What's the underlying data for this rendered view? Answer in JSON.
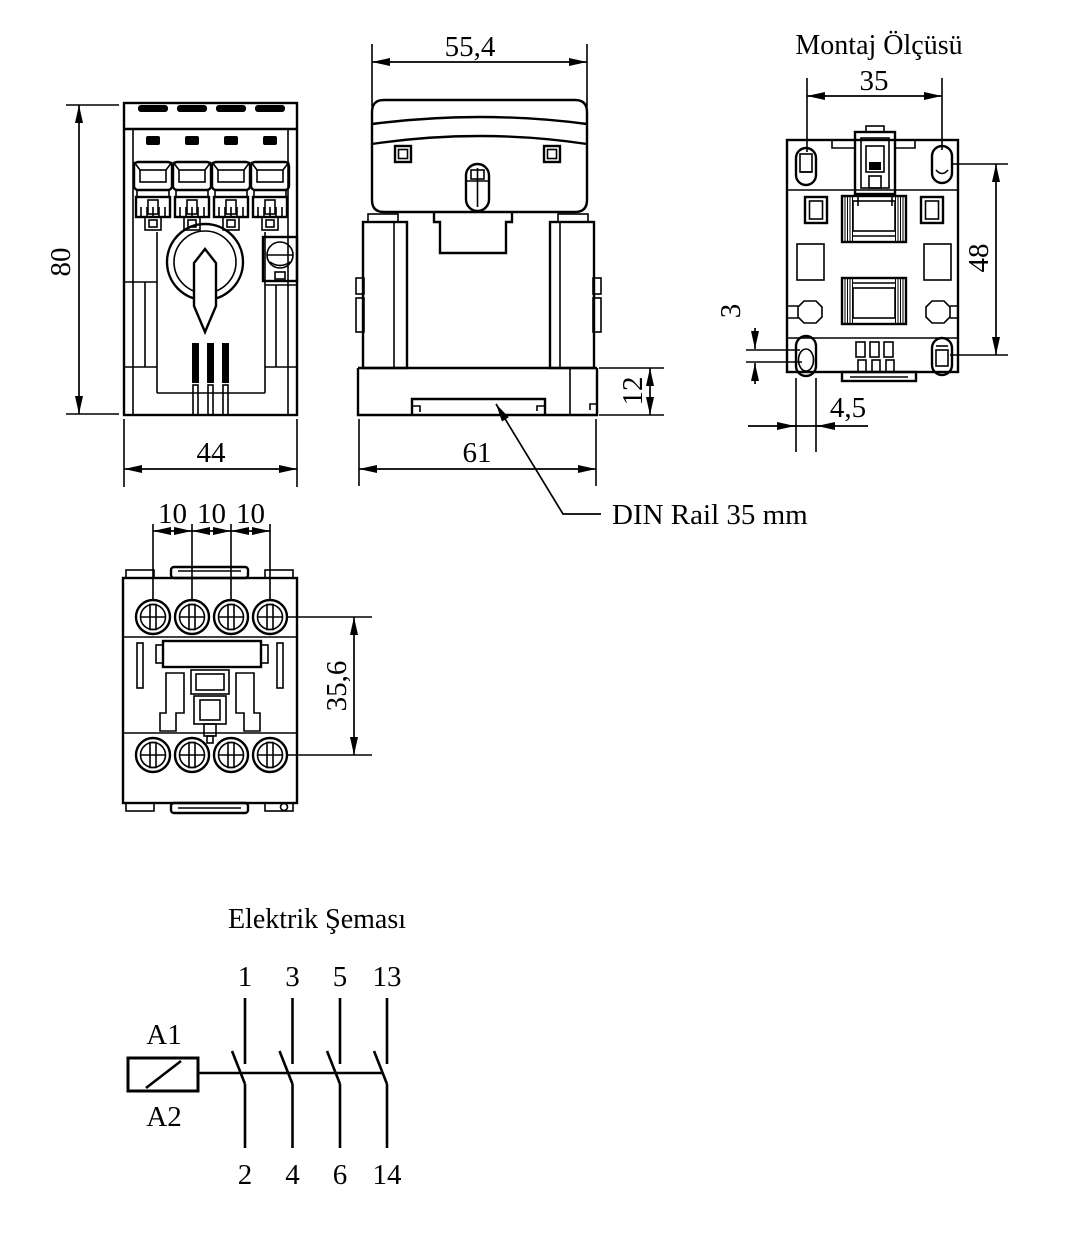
{
  "page": {
    "background": "#ffffff",
    "line_color": "#000000"
  },
  "views": {
    "front": {
      "dims": {
        "height": "80",
        "width": "44"
      }
    },
    "side": {
      "dims": {
        "width": "55,4",
        "rail_height": "12",
        "base_width": "61"
      },
      "callout": "DIN Rail 35 mm"
    },
    "mounting": {
      "title": "Montaj Ölçüsü",
      "dims": {
        "hole_pitch_x": "35",
        "hole_pitch_y": "48",
        "slot_offset": "3",
        "slot_width": "4,5"
      }
    },
    "bottom": {
      "dims": {
        "pitch_1": "10",
        "pitch_2": "10",
        "pitch_3": "10",
        "row_distance": "35,6"
      }
    },
    "schematic": {
      "title": "Elektrik Şeması",
      "coil": {
        "top": "A1",
        "bottom": "A2"
      },
      "top_terminals": [
        "1",
        "3",
        "5",
        "13"
      ],
      "bottom_terminals": [
        "2",
        "4",
        "6",
        "14"
      ]
    }
  }
}
